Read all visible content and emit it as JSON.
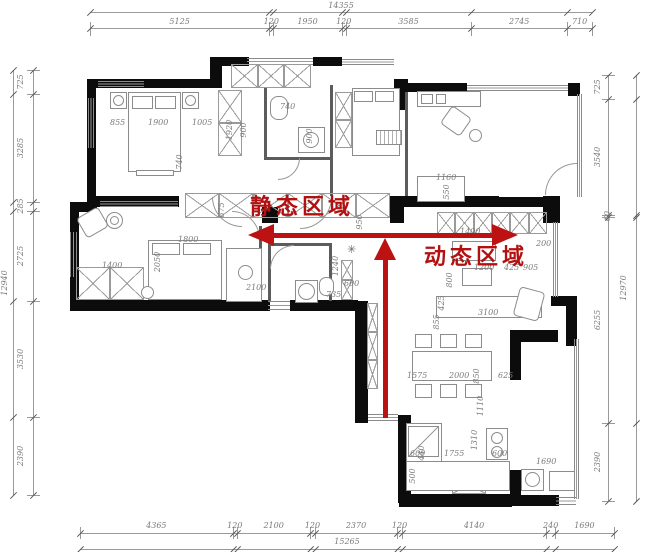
{
  "zones": {
    "static": "静态区域",
    "dynamic": "动态区域"
  },
  "colors": {
    "red_arrow": "#bc1212",
    "wall": "#0c0c0c",
    "dim_text": "#7a7a7a"
  },
  "dim_chains": {
    "top": {
      "total": "14355",
      "segments": [
        "5125",
        "120",
        "1950",
        "120",
        "3585",
        "2745",
        "710"
      ]
    },
    "bottom": {
      "total": "15265",
      "segments": [
        "4365",
        "120",
        "2100",
        "120",
        "2370",
        "120",
        "4140",
        "240",
        "1690"
      ]
    },
    "left": {
      "total": "12940",
      "segments": [
        "725",
        "3285",
        "285",
        "2725",
        "3530",
        "2390"
      ]
    },
    "right": {
      "total": "12970",
      "segments": [
        "725",
        "3540",
        "60",
        "6255",
        "2390"
      ]
    }
  },
  "interior_dims": [
    {
      "t": "855",
      "x": 110,
      "y": 119
    },
    {
      "t": "1900",
      "x": 148,
      "y": 119
    },
    {
      "t": "1005",
      "x": 192,
      "y": 119
    },
    {
      "t": "1920",
      "x": 230,
      "y": 130,
      "r": 1
    },
    {
      "t": "900",
      "x": 244,
      "y": 130,
      "r": 1
    },
    {
      "t": "740",
      "x": 180,
      "y": 162,
      "r": 1
    },
    {
      "t": "740",
      "x": 280,
      "y": 103
    },
    {
      "t": "900",
      "x": 310,
      "y": 136,
      "r": 1
    },
    {
      "t": "1160",
      "x": 436,
      "y": 174
    },
    {
      "t": "550",
      "x": 447,
      "y": 192,
      "r": 1
    },
    {
      "t": "1400",
      "x": 460,
      "y": 228
    },
    {
      "t": "200",
      "x": 536,
      "y": 240
    },
    {
      "t": "1200",
      "x": 474,
      "y": 264
    },
    {
      "t": "425",
      "x": 504,
      "y": 264
    },
    {
      "t": "905",
      "x": 523,
      "y": 264
    },
    {
      "t": "800",
      "x": 450,
      "y": 280,
      "r": 1
    },
    {
      "t": "425",
      "x": 442,
      "y": 303,
      "r": 1
    },
    {
      "t": "3100",
      "x": 478,
      "y": 309
    },
    {
      "t": "855",
      "x": 437,
      "y": 322,
      "r": 1
    },
    {
      "t": "1575",
      "x": 407,
      "y": 372
    },
    {
      "t": "2000",
      "x": 449,
      "y": 372
    },
    {
      "t": "850",
      "x": 477,
      "y": 376,
      "r": 1
    },
    {
      "t": "625",
      "x": 498,
      "y": 372
    },
    {
      "t": "1110",
      "x": 481,
      "y": 406,
      "r": 1
    },
    {
      "t": "600",
      "x": 410,
      "y": 450
    },
    {
      "t": "440",
      "x": 422,
      "y": 453,
      "r": 1
    },
    {
      "t": "1755",
      "x": 444,
      "y": 450
    },
    {
      "t": "1310",
      "x": 475,
      "y": 440,
      "r": 1
    },
    {
      "t": "600",
      "x": 492,
      "y": 450
    },
    {
      "t": "500",
      "x": 413,
      "y": 476,
      "r": 1
    },
    {
      "t": "1690",
      "x": 536,
      "y": 458
    },
    {
      "t": "1400",
      "x": 102,
      "y": 262
    },
    {
      "t": "1800",
      "x": 178,
      "y": 236
    },
    {
      "t": "2050",
      "x": 158,
      "y": 262,
      "r": 1
    },
    {
      "t": "2100",
      "x": 246,
      "y": 284
    },
    {
      "t": "675",
      "x": 222,
      "y": 210,
      "r": 1
    },
    {
      "t": "950",
      "x": 360,
      "y": 222,
      "r": 1
    },
    {
      "t": "1240",
      "x": 336,
      "y": 266,
      "r": 1
    },
    {
      "t": "600",
      "x": 344,
      "y": 280
    },
    {
      "t": "735",
      "x": 326,
      "y": 291
    }
  ]
}
